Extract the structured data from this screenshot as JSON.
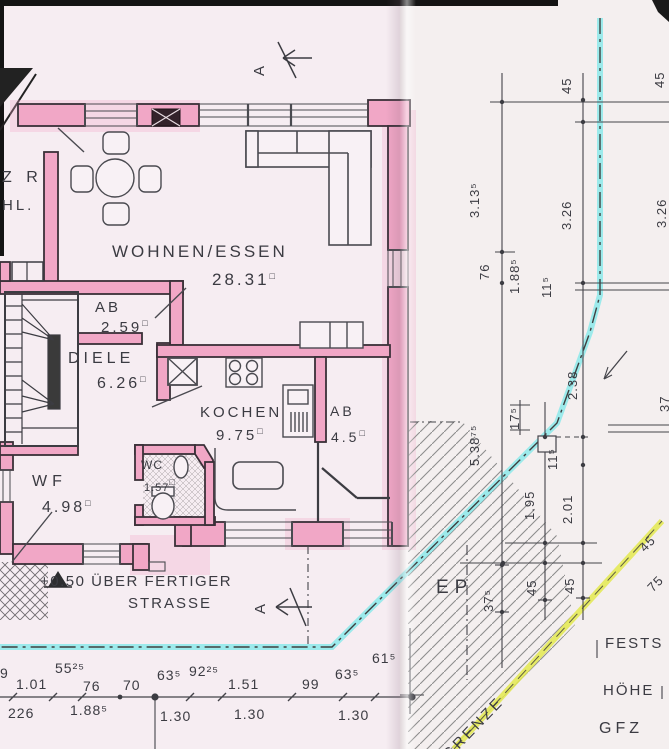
{
  "title": "Erdgeschoss Grundriss (scanned floor plan)",
  "colors": {
    "wall_pink": "#f1a7c6",
    "highlight_cyan": "#86e9ea",
    "highlight_yellow": "#e3e94f",
    "paper": "#f6edf2",
    "ink": "#3b3b42"
  },
  "unit_symbol": "□",
  "rooms": [
    {
      "name": "WOHNEN/ESSEN",
      "area": "28.31"
    },
    {
      "name": "AB",
      "area": "2.59"
    },
    {
      "name": "DIELE",
      "area": "6.26"
    },
    {
      "name": "KOCHEN",
      "area": "9.75"
    },
    {
      "name": "AB",
      "area": "4.5"
    },
    {
      "name": "WC",
      "area": "1.57"
    },
    {
      "name": "WF",
      "area": "4.98"
    }
  ],
  "partial_rooms": {
    "top": "Z R",
    "bottom": "HL."
  },
  "notes": {
    "level_line1": "+0.50 ÜBER FERTIGER",
    "level_line2": "STRASSE",
    "section_label": "A",
    "ep": "EP",
    "grenze": "GRENZE"
  },
  "edge_texts": {
    "t1": "FESTS",
    "t2": "HÖHE",
    "t3": "GFZ"
  },
  "dims_right": [
    "45",
    "3.13⁵",
    "3.26",
    "76",
    "1.88⁵",
    "11⁵",
    "2.38",
    "5.38⁷⁵",
    "17⁵",
    "1.95",
    "11⁵",
    "2.01",
    "37⁵",
    "45",
    "45",
    "45",
    "3.26",
    "37"
  ],
  "dims_bottom_top": [
    "9",
    "1.01",
    "55²⁵",
    "76",
    "70",
    "63⁵",
    "92²⁵",
    "1.51",
    "99",
    "63⁵",
    "61⁵"
  ],
  "dims_bottom_bottom": [
    "226",
    "1.88⁵",
    "1.30",
    "1.30",
    "1.30"
  ],
  "dims_diagonal": [
    "45",
    "75"
  ]
}
